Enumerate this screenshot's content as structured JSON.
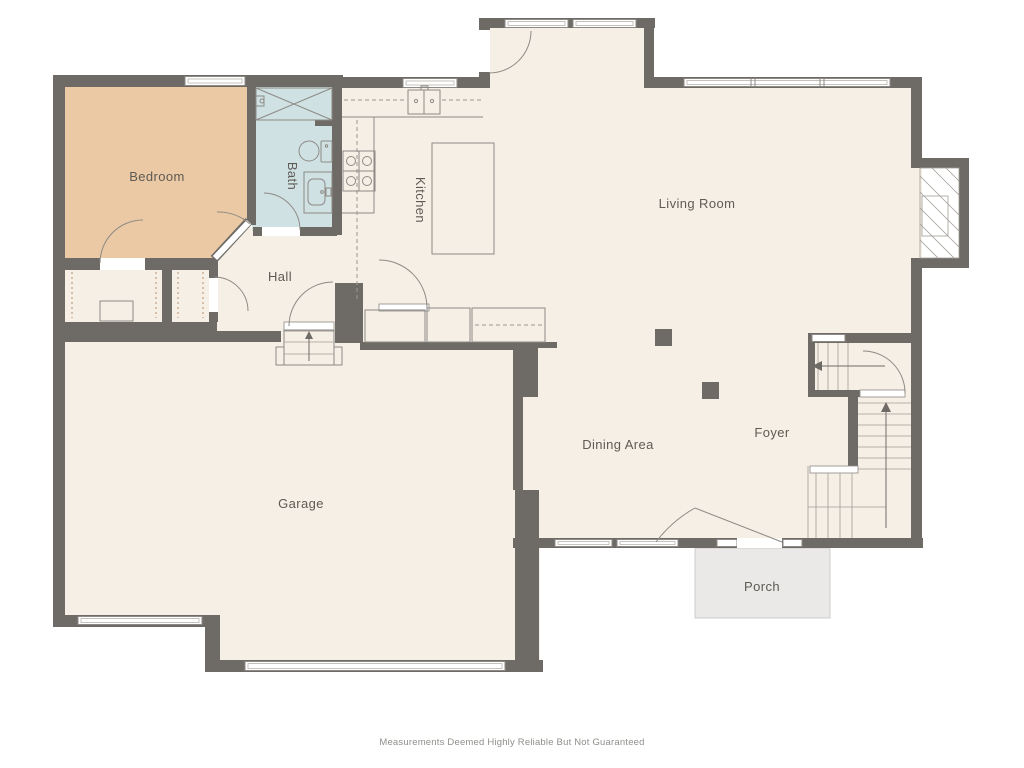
{
  "rooms": {
    "bedroom": "Bedroom",
    "bath": "Bath",
    "kitchen": "Kitchen",
    "hall": "Hall",
    "living_room": "Living Room",
    "dining_area": "Dining Area",
    "foyer": "Foyer",
    "garage": "Garage",
    "porch": "Porch"
  },
  "disclaimer": "Measurements Deemed Highly Reliable But Not Guaranteed",
  "colors": {
    "background": "#ffffff",
    "wall": "#6e6b66",
    "floor": "#f6efe6",
    "bedroom": "#ebc9a4",
    "bath": "#cfe1e3",
    "porch": "#eae9e7",
    "line": "#8d8a85",
    "closet_dash": "#c59d79",
    "label_text": "#5e5a54",
    "disclaimer_text": "#918f8b"
  }
}
